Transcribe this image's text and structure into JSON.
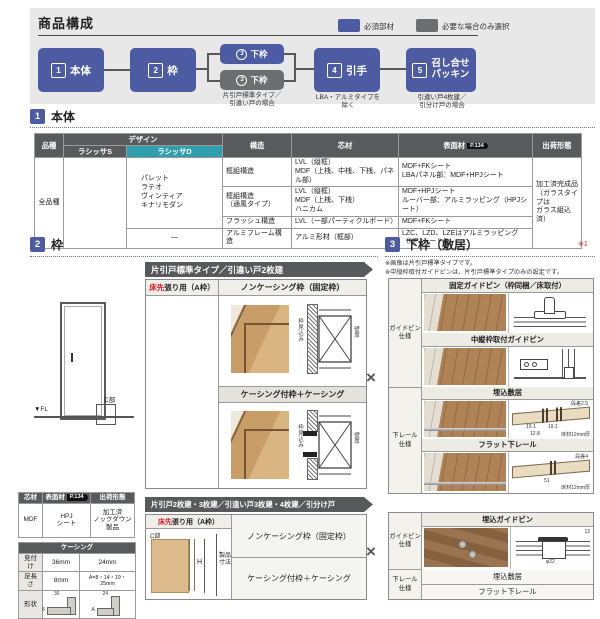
{
  "colors": {
    "accent_blue": "#4d5ba3",
    "optional_gray": "#6d6e70",
    "teal": "#2f9fad",
    "red": "#d51c24"
  },
  "top": {
    "title": "商品構成",
    "legend_required": "必須部材",
    "legend_optional": "必要な場合のみ選択",
    "node1_num": "1",
    "node1_label": "本体",
    "node2_num": "2",
    "node2_label": "枠",
    "node3a_num": "3",
    "node3a_label": "下枠",
    "node3b_num": "3",
    "node3b_label": "下枠",
    "note3": "片引戸標準タイプ／\n引違い戸の場合",
    "node4_num": "4",
    "node4_label": "引手",
    "note4": "LBA・アルミタイプを\n除く",
    "node5_num": "5",
    "node5_label": "召し合せ\nパッキン",
    "note5": "引違い戸4枚建／\n引分け戸の場合"
  },
  "sec1": {
    "num": "1",
    "title": "本体",
    "h_hinshu": "品種",
    "h_design": "デザイン",
    "h_lasissa_s": "ラシッサS",
    "h_lasissa_d": "ラシッサD",
    "h_kouzou": "構造",
    "h_shinzai": "芯材",
    "h_hyomen": "表面材",
    "badge": "P.134",
    "h_shukka": "出荷形態",
    "hinshu": "全品種",
    "designs": "パレット\nラテオ\nヴィンティア\nキナリモダン",
    "design_dash": "—",
    "r1_kouzou": "框組構造",
    "r1_shinzai": "LVL（縦框）\nMDF（上桟、中桟、下桟、パネル部）",
    "r1_hyomen": "MDF+FKシート\nLBAパネル部：MDF+HPJシート",
    "r2_kouzou": "框組構造\n（通風タイプ）",
    "r2_shinzai": "LVL（縦框）\nMDF（上桟、下桟）\nハニカム",
    "r2_hyomen": "MDF+HPJシート\nルーバー部：アルミラッピング（HPJシート）",
    "r3_kouzou": "フラッシュ構造",
    "r3_shinzai": "LVL（一部パーティクルボード）",
    "r3_hyomen": "MDF+FKシート",
    "r4_kouzou": "アルミフレーム構造",
    "r4_shinzai": "アルミ形材（框部）",
    "r4_hyomen": "LZC、LZD、LZEはアルミラッピング（HPJシート）",
    "shukka": "加工済完成品\n（ガラスタイプは\nガラス組込済）"
  },
  "sec2": {
    "num": "2",
    "title": "枠",
    "fl": "▼FL",
    "cbu": "C部",
    "banner1": "片引戸標準タイプ／引違い戸2枚建",
    "banner2": "片引戸2枚建・3枚建／引違い戸3枚建・4枚建／引分け戸",
    "yukasaki": "床先",
    "yukasaki_rest": "張り用（A枠）",
    "noncasing": "ノンケーシング枠（固定枠）",
    "casing": "ケーシング付枠＋ケーシング",
    "wakumikomi": "枠見込み",
    "kabeatsu": "壁厚",
    "h_dim": "H",
    "seihin": "製品\n寸法",
    "cross": "×",
    "mat_shinzai_h": "芯材",
    "mat_hyomen_h": "表面材",
    "mat_badge": "P.134",
    "mat_shukka_h": "出荷形態",
    "mat_shinzai": "MDF",
    "mat_hyomen": "HPJ\nシート",
    "mat_shukka": "加工済\nノックダウン\n製品",
    "casing_title": "ケーシング",
    "mitsuke": "見付け",
    "mitsuke_v1": "36mm",
    "mitsuke_v2": "24mm",
    "ashinaga": "足長さ",
    "ashinaga_v1": "8mm",
    "ashinaga_v2": "A=8・14・19・25mm",
    "keijou": "形状",
    "s1_top": "36",
    "s1_side": "8",
    "s2_top": "24",
    "s2_side": "A"
  },
  "sec3": {
    "num": "3",
    "title": "下枠（敷居）",
    "ref": "※1",
    "note1": "※画像は片引戸標準タイプです。",
    "note2": "※中縦枠取付ガイドピンは、片引戸標準タイプのみの設定です。",
    "guidepin": "ガイドピン\n仕様",
    "rail": "下レール\n仕様",
    "fixed_pin": "固定ガイドピン（枠同梱／床取付）",
    "center_pin": "中縦枠取付ガイドピン",
    "umekomi": "埋込敷居",
    "flat": "フラット下レール",
    "u_dansa": "段差2.5",
    "u_191a": "19.1",
    "u_191b": "19.1",
    "u_128": "12.8",
    "u_yuka": "床材12mm厚",
    "f_dansa": "段差4",
    "f_51": "51",
    "f_yuka": "床材12mm厚",
    "t2_guidepin": "ガイドピン\n仕様",
    "t2_rail": "下レール\n仕様",
    "t2_pin": "埋込ガイドピン",
    "t2_dia": "φ22",
    "t2_depth": "12",
    "t2_umekomi": "埋込敷居",
    "t2_flat": "フラット下レール"
  }
}
